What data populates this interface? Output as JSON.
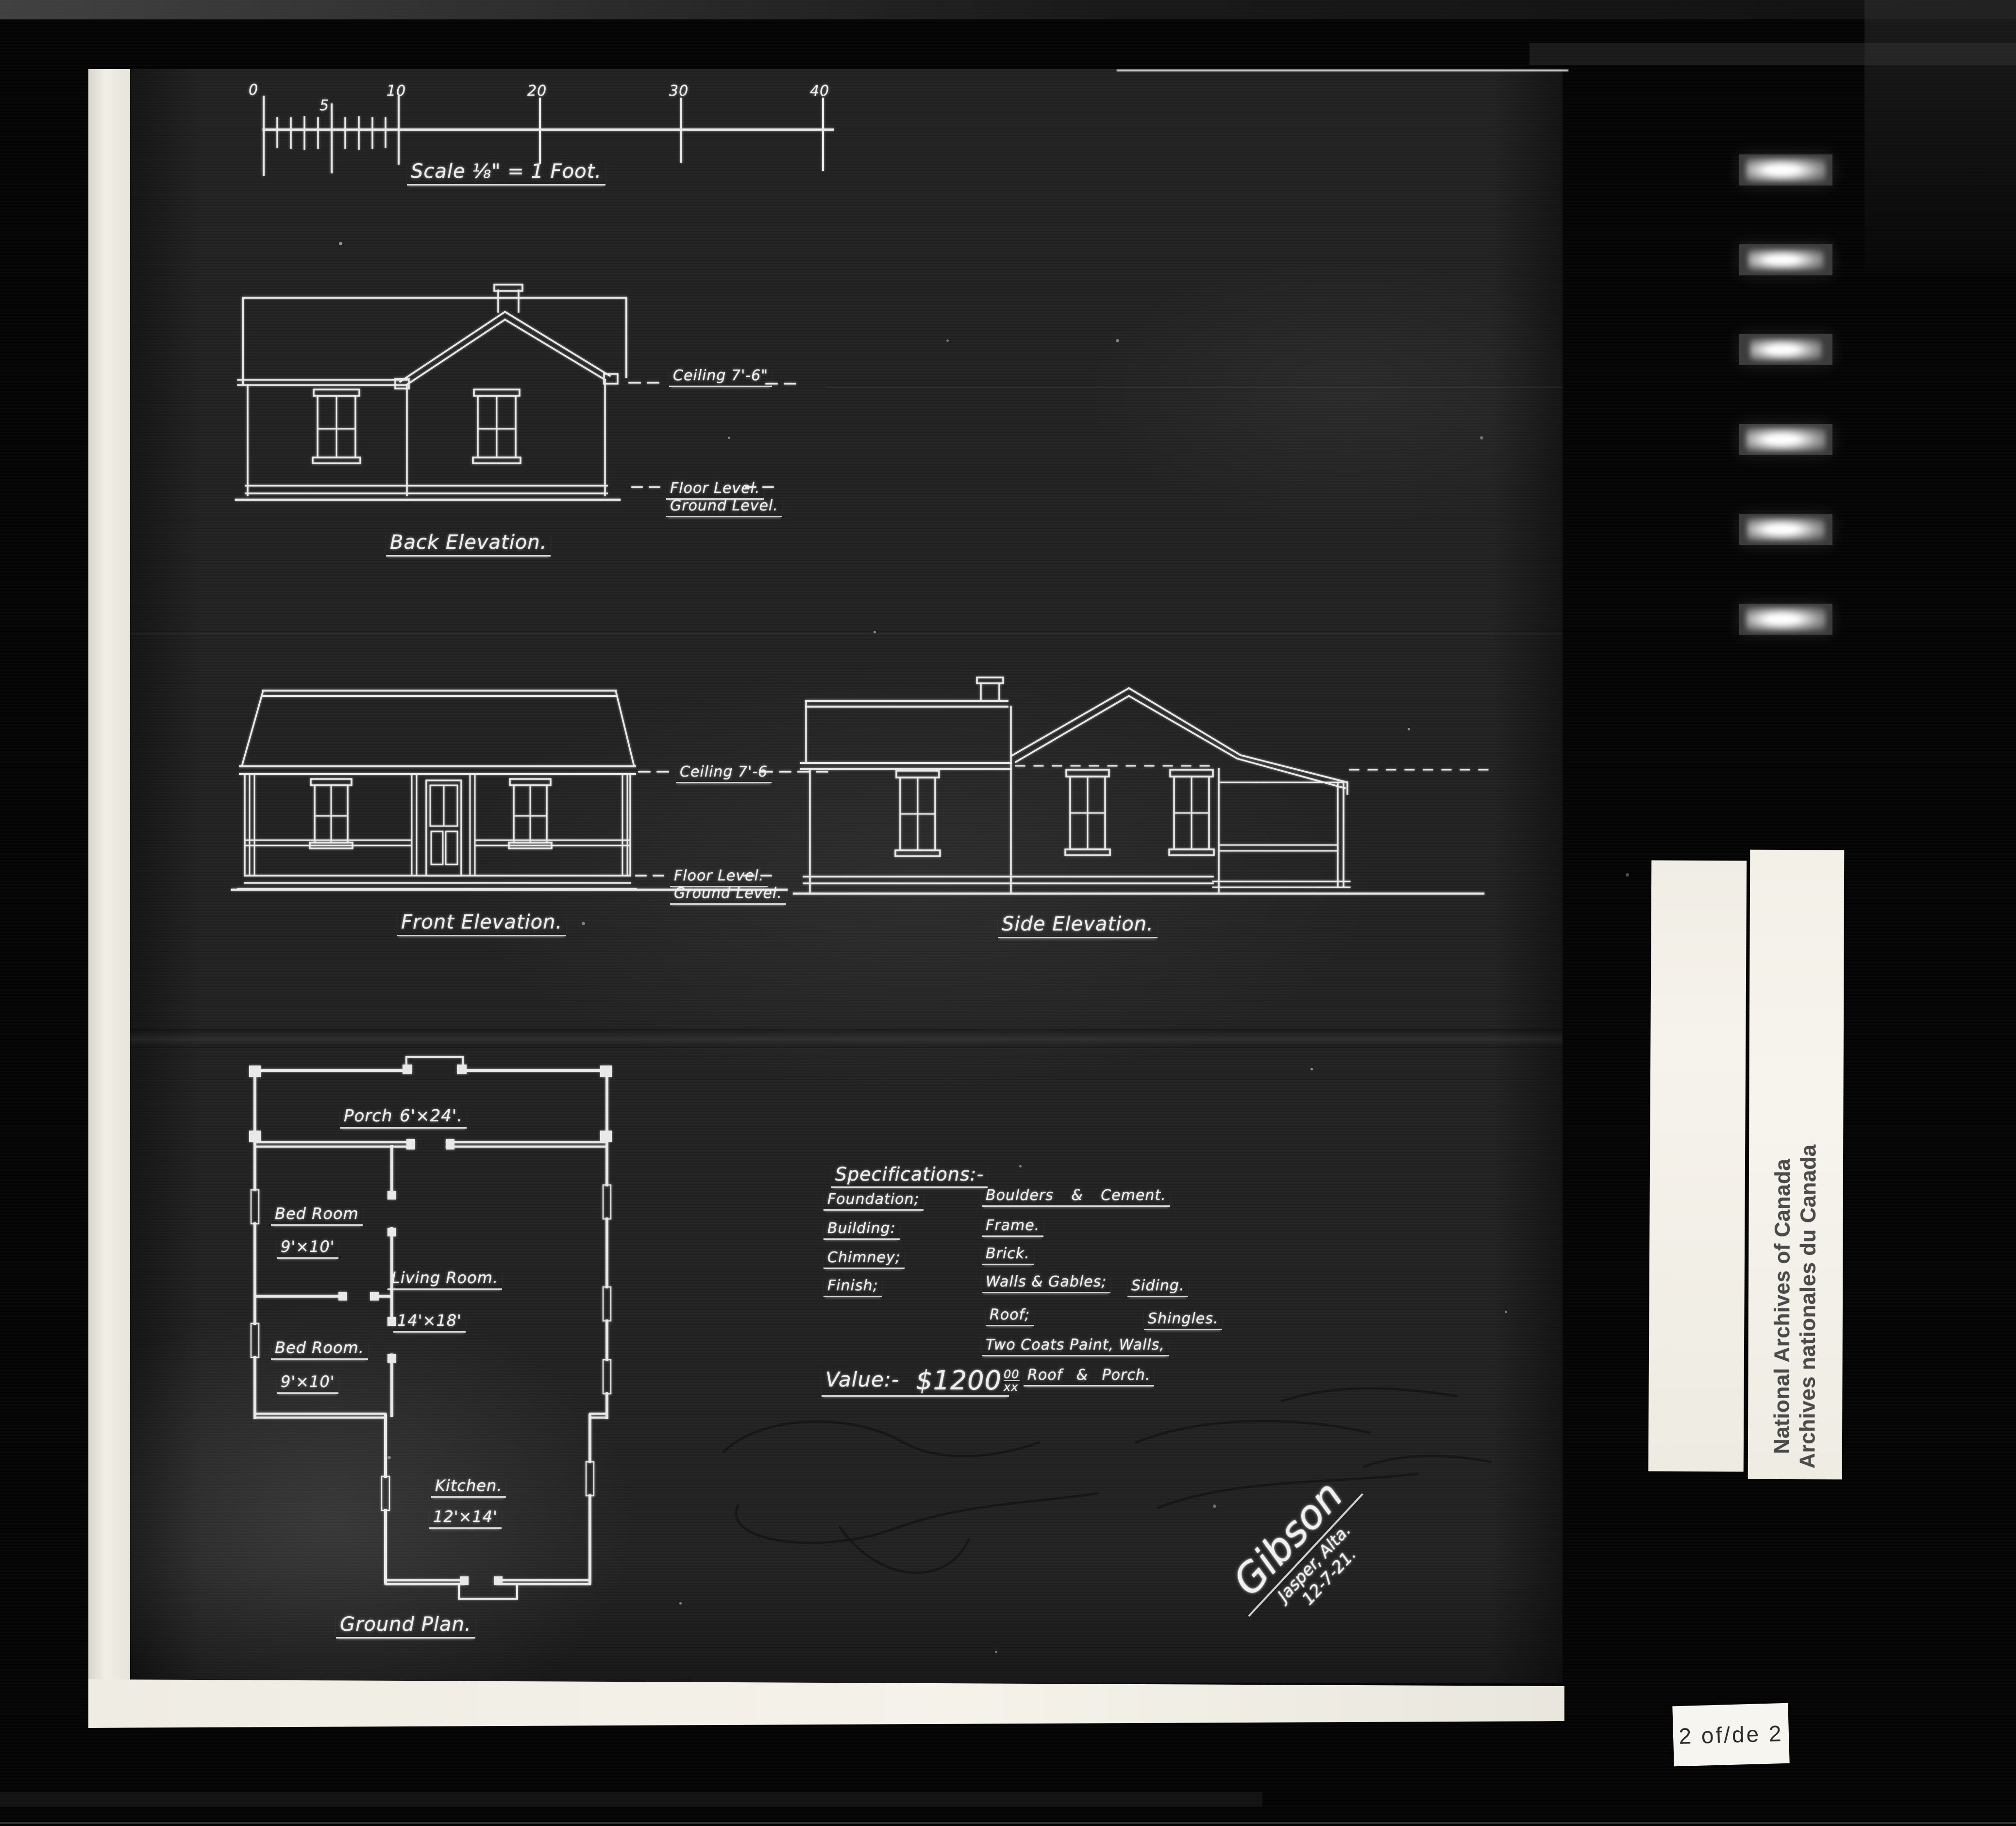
{
  "scale_bar": {
    "ticks": [
      "0",
      "5",
      "10",
      "20",
      "30",
      "40"
    ],
    "caption": "Scale ⅛\" = 1 Foot."
  },
  "back_elevation": {
    "title": "Back Elevation.",
    "ceiling": "Ceiling 7'-6\"",
    "floor": "Floor Level.",
    "ground": "Ground Level."
  },
  "front_elevation": {
    "title": "Front Elevation.",
    "ceiling": "Ceiling 7'-6",
    "floor": "Floor Level.",
    "ground": "Ground Level."
  },
  "side_elevation": {
    "title": "Side Elevation."
  },
  "ground_plan": {
    "title": "Ground Plan.",
    "rooms": [
      {
        "name": "Porch",
        "size": "6'×24'."
      },
      {
        "name": "Bed Room",
        "size": "9'×10'"
      },
      {
        "name": "Living Room.",
        "size": "14'×18'"
      },
      {
        "name": "Bed Room.",
        "size": "9'×10'"
      },
      {
        "name": "Kitchen.",
        "size": "12'×14'"
      }
    ]
  },
  "specifications": {
    "title": "Specifications:-",
    "foundation_label": "Foundation;",
    "foundation_value": "Boulders & Cement.",
    "building_label": "Building:",
    "building_value": "Frame.",
    "chimney_label": "Chimney;",
    "chimney_value": "Brick.",
    "finish_label": "Finish;",
    "finish_value_1": "Walls & Gables;",
    "finish_value_2": "Siding.",
    "roof_label": "Roof;",
    "roof_value": "Shingles.",
    "paint_line": "Two Coats Paint,  Walls,",
    "paint_line_2": "Roof & Porch."
  },
  "value": {
    "label": "Value:-",
    "amount": "$1200",
    "cents": "00",
    "cents_sub": "xx"
  },
  "signature": {
    "name": "Gibson",
    "place": "Jasper, Alta.",
    "date": "12-7-21."
  },
  "archive": {
    "stamp_line_1": "National Archives of Canada",
    "stamp_line_2": "Archives nationales du Canada",
    "page_label": "2 of/de 2"
  }
}
